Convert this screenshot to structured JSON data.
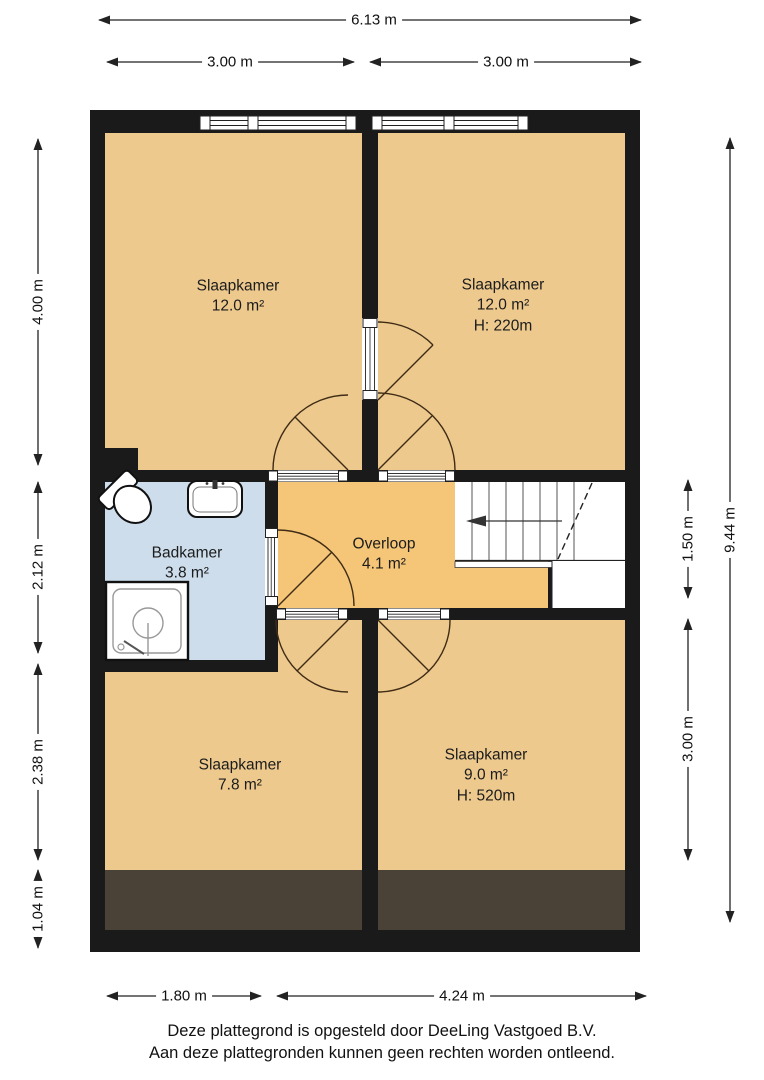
{
  "dimensions": {
    "top_total": "6.13 m",
    "top_left_half": "3.00 m",
    "top_right_half": "3.00 m",
    "left_upper": "4.00 m",
    "left_middle": "2.12 m",
    "left_lower": "2.38 m",
    "left_bottom": "1.04 m",
    "right_stair": "1.50 m",
    "right_lower": "3.00 m",
    "right_total": "9.44 m",
    "bottom_left": "1.80 m",
    "bottom_right": "4.24 m"
  },
  "rooms": {
    "bedroom_top_left": {
      "name": "Slaapkamer",
      "area": "12.0 m²"
    },
    "bedroom_top_right": {
      "name": "Slaapkamer",
      "area": "12.0 m²",
      "height": "H: 220m"
    },
    "bathroom": {
      "name": "Badkamer",
      "area": "3.8 m²"
    },
    "landing": {
      "name": "Overloop",
      "area": "4.1 m²"
    },
    "bedroom_bottom_left": {
      "name": "Slaapkamer",
      "area": "7.8 m²"
    },
    "bedroom_bottom_right": {
      "name": "Slaapkamer",
      "area": "9.0 m²",
      "height": "H: 520m"
    }
  },
  "fixtures": [
    "toilet",
    "sink",
    "shower",
    "stairs"
  ],
  "footer": {
    "line1": "Deze plattegrond is opgesteld door DeeLing Vastgoed B.V.",
    "line2": "Aan deze plattegronden kunnen geen rechten worden ontleend."
  },
  "colors": {
    "wall": "#1a1a1a",
    "room_fill": "#edc98e",
    "landing_fill": "#f5c578",
    "bathroom_fill": "#cdddec",
    "low_headroom_fill": "#4a4237",
    "dimension": "#222222"
  }
}
